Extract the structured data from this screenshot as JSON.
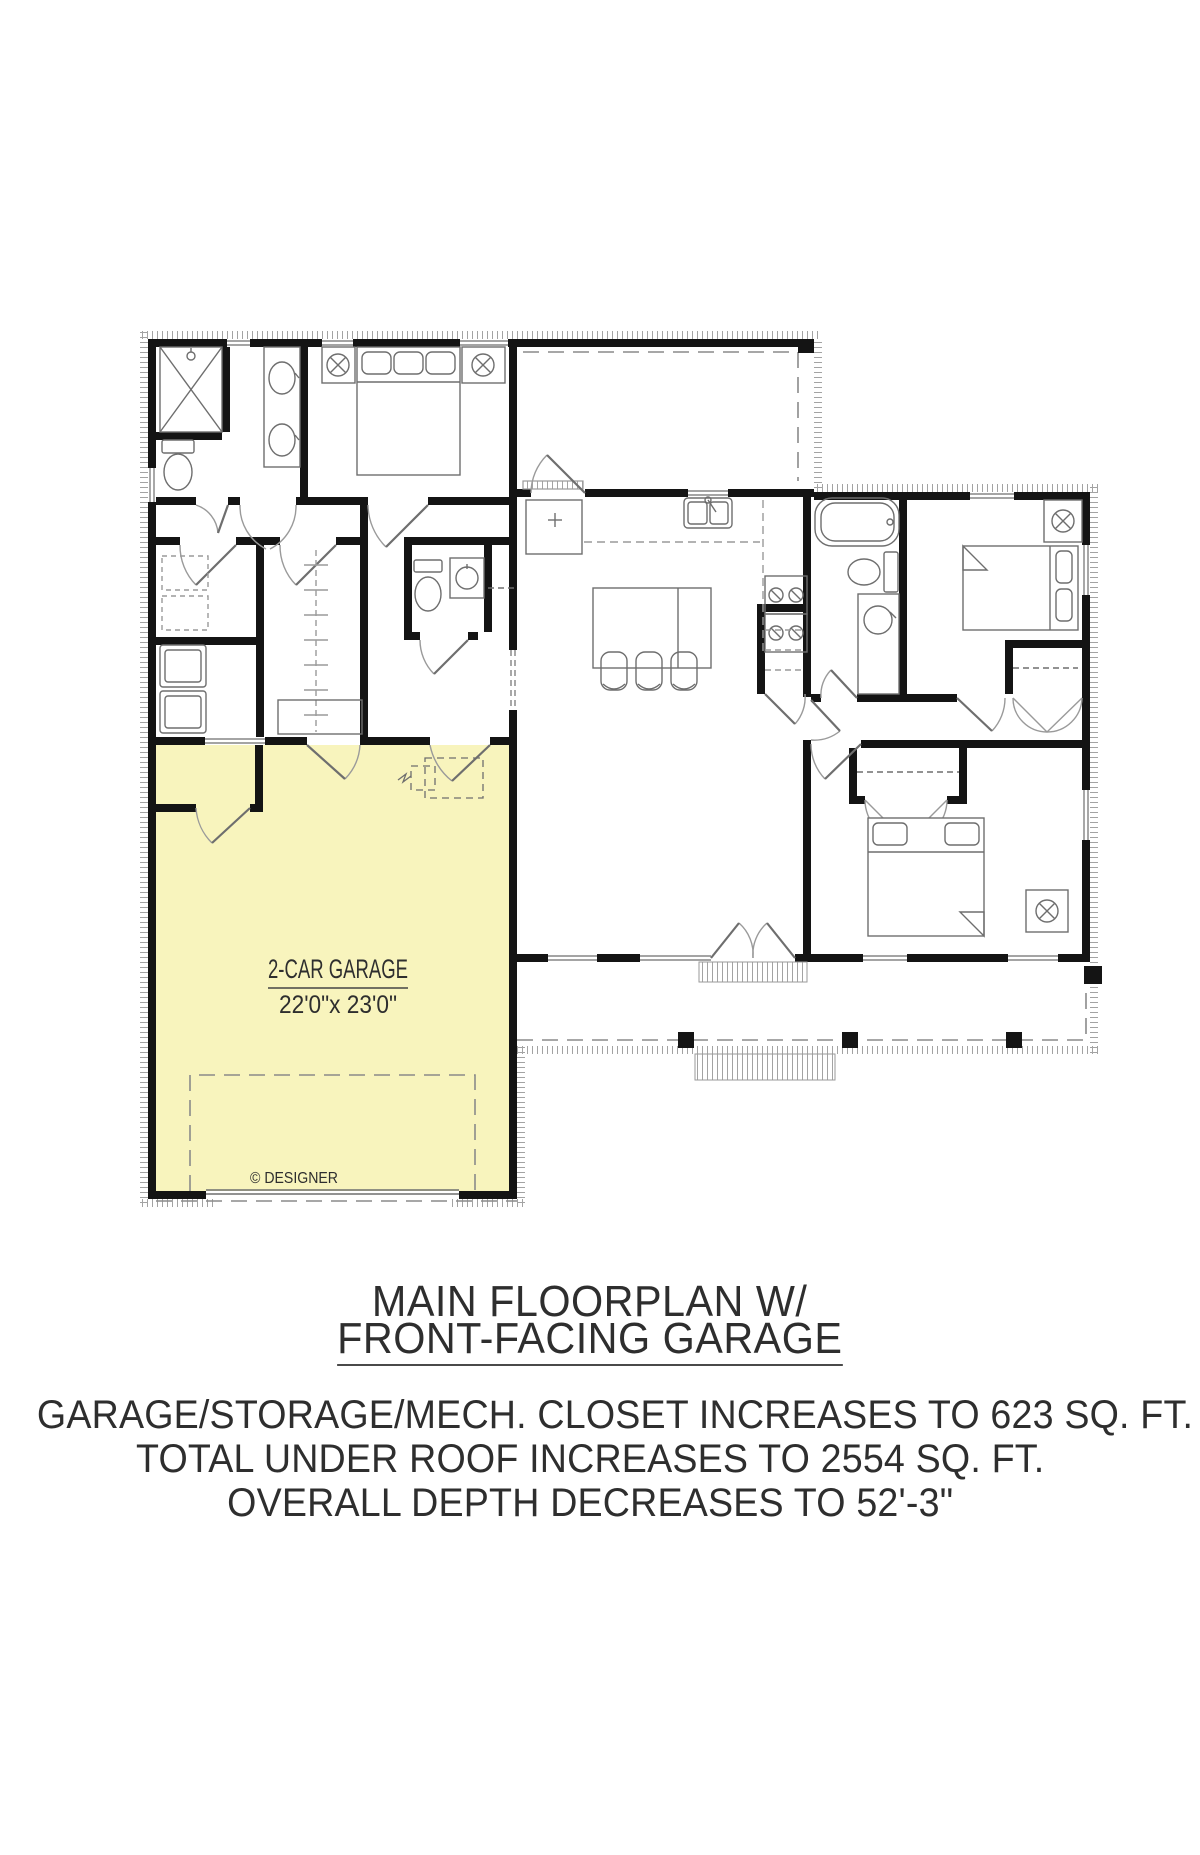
{
  "document": {
    "title_line1": "MAIN FLOORPLAN W/",
    "title_line2": "FRONT-FACING GARAGE",
    "notes": [
      "GARAGE/STORAGE/MECH. CLOSET INCREASES TO 623 SQ. FT.",
      "TOTAL UNDER ROOF INCREASES TO 2554 SQ. FT.",
      "OVERALL DEPTH DECREASES TO 52'-3\""
    ]
  },
  "plan": {
    "garage_label": "2-CAR GARAGE",
    "garage_dimensions": "22'0\"x 23'0\"",
    "copyright": "© DESIGNER",
    "highlighted_area": "garage-storage-mech-closet"
  },
  "colors": {
    "paper": "#ffffff",
    "wall": "#141414",
    "line": "#6e6e6e",
    "lightline": "#9a9a9a",
    "hatch": "#a3a3a3",
    "garage": "#f8f4bd",
    "text": "#2e2e2e",
    "dash": "#8a8a8a"
  }
}
